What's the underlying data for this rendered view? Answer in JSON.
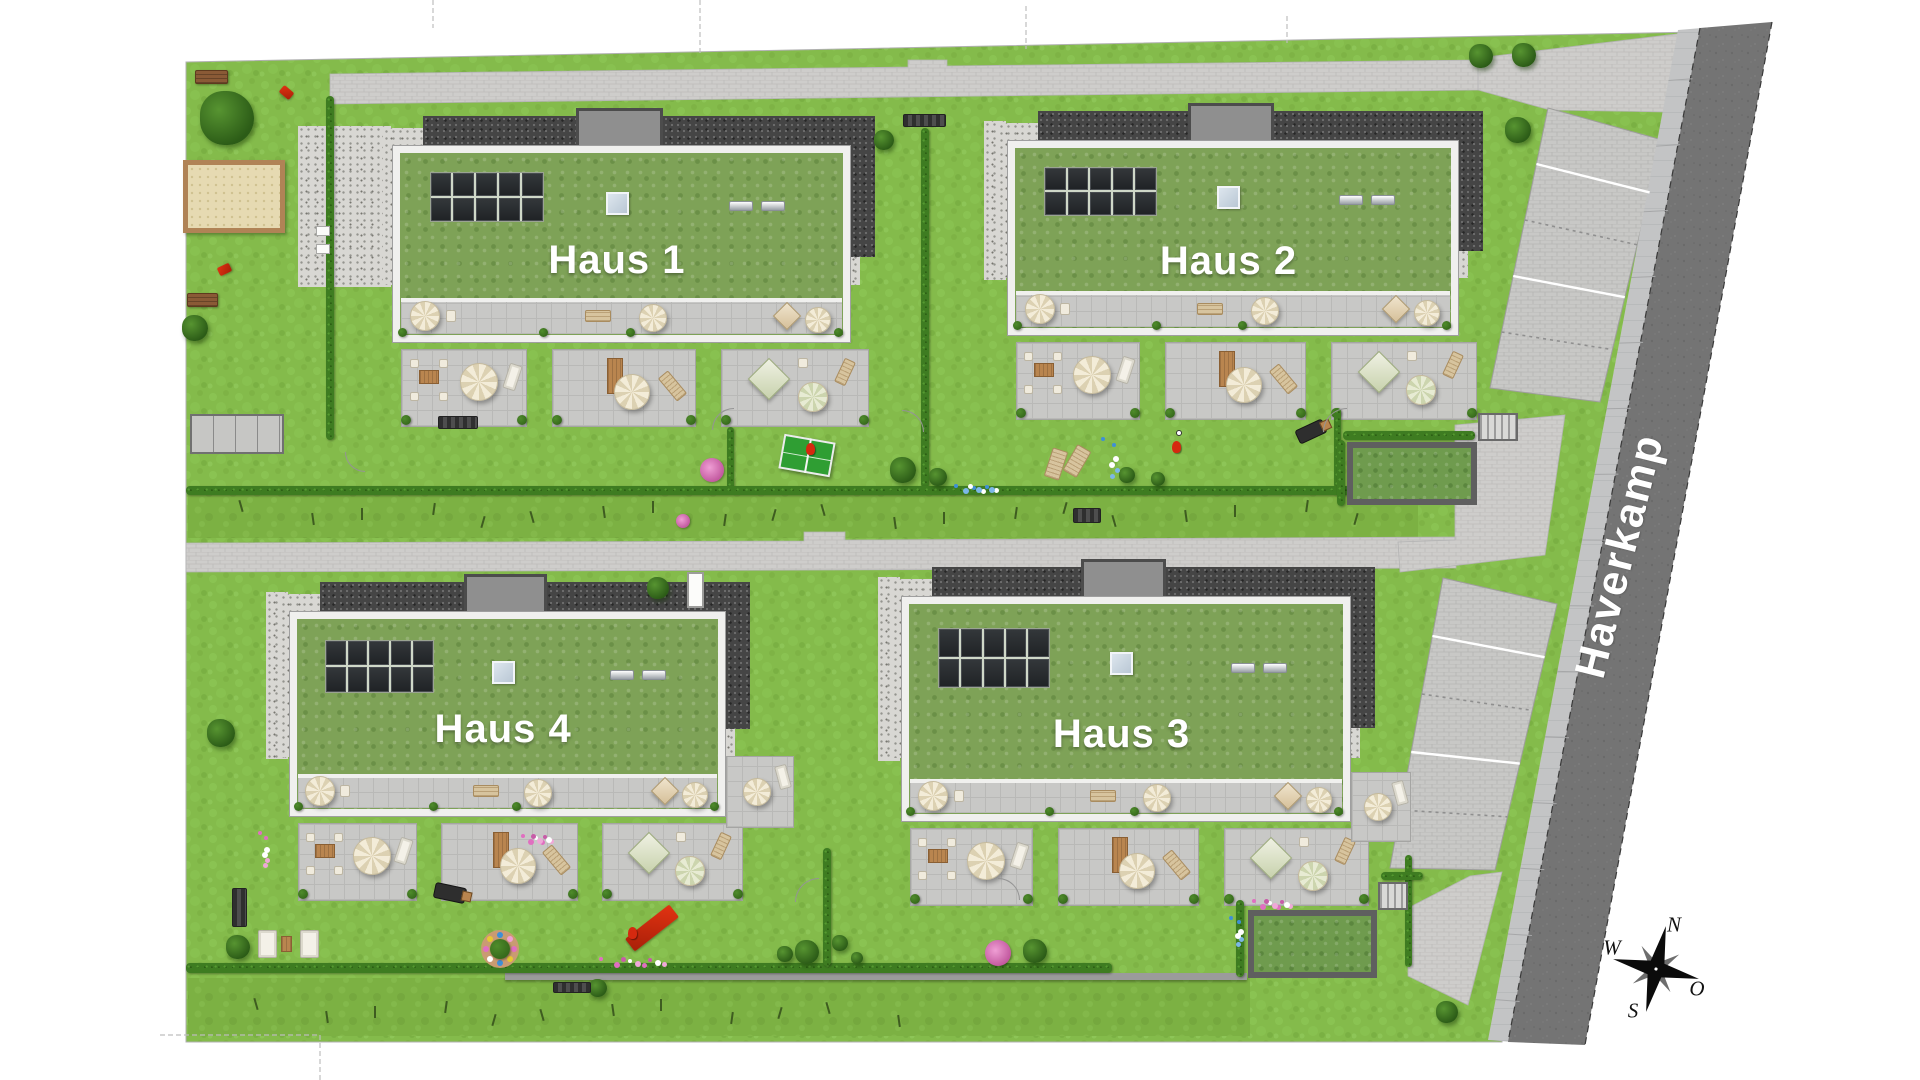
{
  "street": {
    "name": "Haverkamp"
  },
  "compass": {
    "n": "N",
    "o": "O",
    "s": "S",
    "w": "W"
  },
  "houses": [
    {
      "label": "Haus 1",
      "bx": 393,
      "by": 146,
      "bw": 457,
      "bh": 196,
      "attic": 44,
      "court": 95,
      "labelFrac": 0.75
    },
    {
      "label": "Haus 2",
      "bx": 1008,
      "by": 141,
      "bw": 450,
      "bh": 194,
      "attic": 44,
      "court": 24,
      "labelFrac": 0.8
    },
    {
      "label": "Haus 3",
      "bx": 902,
      "by": 597,
      "bw": 448,
      "bh": 224,
      "attic": 42,
      "court": 24,
      "labelFrac": 0.75,
      "extra_pad": [
        1352,
        773,
        58,
        68
      ]
    },
    {
      "label": "Haus 4",
      "bx": 290,
      "by": 612,
      "bw": 435,
      "bh": 204,
      "attic": 42,
      "court": 24,
      "labelFrac": 0.72,
      "extra_pad": [
        727,
        757,
        66,
        70
      ]
    }
  ],
  "palette": {
    "grass": "#84bb4b",
    "meadow": "#7cb143",
    "roof_green": "#7ea257",
    "road": "#747474",
    "sidewalk": "#c3c4c5",
    "paving": "#cecdcb",
    "parking": "#c8c8c6",
    "dark_gravel": "#454545",
    "hedge": "#3e7c21",
    "label_text": "#ffffff",
    "solar": "#2b2e31",
    "accent_red": "#d5290f",
    "sand": "#e6dab2",
    "parapet": "#f0f0ee"
  },
  "scene": {
    "grass": [
      [
        186,
        62
      ],
      [
        1697,
        32
      ],
      [
        1502,
        1042
      ],
      [
        186,
        1042
      ]
    ],
    "meadows": [
      [
        188,
        492,
        1230,
        46
      ],
      [
        188,
        978,
        1062,
        58
      ]
    ],
    "walk_top": [
      [
        330,
        74
      ],
      [
        908,
        67
      ],
      [
        908,
        60
      ],
      [
        947,
        60
      ],
      [
        947,
        66
      ],
      [
        1480,
        60
      ],
      [
        1480,
        90
      ],
      [
        330,
        104
      ]
    ],
    "drive_top": [
      [
        1478,
        58
      ],
      [
        1693,
        32
      ],
      [
        1666,
        112
      ],
      [
        1550,
        110
      ],
      [
        1478,
        90
      ]
    ],
    "walk_mid": [
      [
        186,
        543
      ],
      [
        804,
        541
      ],
      [
        804,
        532
      ],
      [
        845,
        532
      ],
      [
        845,
        540
      ],
      [
        1456,
        537
      ],
      [
        1456,
        568
      ],
      [
        186,
        572
      ]
    ],
    "exit_mid": [
      [
        1455,
        425
      ],
      [
        1565,
        415
      ],
      [
        1545,
        555
      ],
      [
        1400,
        572
      ],
      [
        1398,
        542
      ],
      [
        1455,
        540
      ]
    ],
    "exit_low": [
      [
        1408,
        908
      ],
      [
        1470,
        876
      ],
      [
        1502,
        872
      ],
      [
        1468,
        1005
      ],
      [
        1408,
        976
      ]
    ],
    "park_upper": [
      [
        1548,
        108
      ],
      [
        1662,
        140
      ],
      [
        1600,
        402
      ],
      [
        1490,
        388
      ]
    ],
    "park_lower": [
      [
        1443,
        578
      ],
      [
        1557,
        604
      ],
      [
        1495,
        870
      ],
      [
        1390,
        868
      ]
    ],
    "sidewalk": [
      [
        1678,
        30
      ],
      [
        1702,
        28
      ],
      [
        1512,
        1042
      ],
      [
        1488,
        1040
      ]
    ],
    "road": [
      [
        1700,
        28
      ],
      [
        1772,
        22
      ],
      [
        1585,
        1045
      ],
      [
        1508,
        1042
      ]
    ],
    "road_edges": [
      [
        1700,
        28,
        1508,
        1042
      ],
      [
        1772,
        22,
        1585,
        1045
      ]
    ],
    "boundaries": [
      [
        433,
        0,
        433,
        28
      ],
      [
        700,
        0,
        700,
        53
      ],
      [
        1026,
        6,
        1026,
        49
      ],
      [
        1287,
        16,
        1287,
        43
      ],
      [
        160,
        1035,
        320,
        1035
      ],
      [
        320,
        1035,
        320,
        1080
      ]
    ],
    "wall": [
      505,
      973,
      742,
      7
    ],
    "hedges": [
      [
        326,
        96,
        8,
        344
      ],
      [
        921,
        128,
        8,
        360
      ],
      [
        727,
        427,
        7,
        62
      ],
      [
        1334,
        408,
        7,
        80
      ],
      [
        186,
        486,
        1236,
        9
      ],
      [
        186,
        963,
        926,
        10
      ],
      [
        823,
        848,
        8,
        118
      ],
      [
        1405,
        855,
        7,
        112
      ],
      [
        1381,
        872,
        42,
        8
      ],
      [
        1343,
        431,
        132,
        9
      ],
      [
        1337,
        440,
        8,
        66
      ],
      [
        1236,
        900,
        8,
        77
      ]
    ],
    "trees": [
      [
        227,
        118,
        27
      ],
      [
        884,
        140,
        10
      ],
      [
        1518,
        130,
        13
      ],
      [
        1481,
        56,
        12
      ],
      [
        1524,
        55,
        12
      ],
      [
        195,
        328,
        13
      ],
      [
        221,
        733,
        14
      ],
      [
        903,
        470,
        13
      ],
      [
        938,
        477,
        9
      ],
      [
        1127,
        475,
        8
      ],
      [
        1158,
        479,
        7
      ],
      [
        658,
        588,
        11
      ],
      [
        785,
        954,
        8
      ],
      [
        807,
        952,
        12
      ],
      [
        840,
        943,
        8
      ],
      [
        857,
        958,
        6
      ],
      [
        238,
        947,
        12
      ],
      [
        1035,
        951,
        12
      ],
      [
        1447,
        1012,
        11
      ],
      [
        598,
        988,
        9
      ]
    ],
    "benches_wood": [
      [
        195,
        70,
        33,
        14
      ],
      [
        187,
        293,
        31,
        14
      ]
    ],
    "benches_dark": [
      [
        903,
        114,
        43,
        13
      ],
      [
        438,
        416,
        40,
        13
      ],
      [
        1073,
        508,
        28,
        15
      ],
      [
        232,
        888,
        15,
        39
      ],
      [
        553,
        982,
        38,
        11
      ]
    ],
    "sandbox": [
      183,
      160,
      102,
      73
    ],
    "bike_shelter": [
      190,
      414,
      94,
      40
    ],
    "green_shelters": [
      [
        1347,
        442,
        130,
        63
      ],
      [
        1248,
        910,
        129,
        68
      ]
    ],
    "stairs": [
      [
        1478,
        413,
        40,
        28
      ],
      [
        1378,
        882,
        30,
        28
      ]
    ],
    "pingpong": [
      781,
      438,
      52,
      35,
      10
    ],
    "garden_loungers": [
      [
        1048,
        449,
        16,
        30,
        18
      ],
      [
        1069,
        446,
        16,
        30,
        30
      ],
      [
        258,
        930,
        19,
        28,
        0
      ],
      [
        300,
        930,
        19,
        28,
        0
      ]
    ],
    "small_table": [
      281,
      936,
      11,
      16
    ],
    "grills": [
      [
        1296,
        424,
        30,
        15,
        -25
      ],
      [
        434,
        885,
        32,
        16,
        12
      ]
    ],
    "red_toys": [
      [
        280,
        88,
        13,
        9,
        40
      ],
      [
        218,
        265,
        13,
        9,
        -25
      ]
    ],
    "red_slide": [
      644,
      900,
      16,
      56,
      52
    ],
    "red_figures": [
      [
        1172,
        441
      ],
      [
        628,
        927
      ],
      [
        806,
        443
      ]
    ],
    "ball": [
      1176,
      430
    ],
    "flower_blue_v": [
      [
        1100,
        432,
        16,
        54
      ],
      [
        1228,
        912,
        12,
        38
      ]
    ],
    "flower_rows": [
      [
        950,
        483,
        48,
        8,
        "blue"
      ],
      [
        593,
        956,
        76,
        9,
        "pink"
      ],
      [
        1248,
        898,
        44,
        9,
        "pink"
      ],
      [
        518,
        833,
        34,
        9,
        "pink"
      ]
    ],
    "flower_pink_v": [
      257,
      826,
      9,
      48
    ],
    "flower_bushes": [
      [
        712,
        470,
        12
      ],
      [
        998,
        953,
        13
      ],
      [
        683,
        521,
        7
      ]
    ],
    "flowerbed": [
      500,
      949,
      19
    ],
    "white_box": [
      687,
      572,
      17,
      36
    ],
    "court_items": [
      [
        316,
        226,
        14,
        10
      ],
      [
        316,
        244,
        14,
        10
      ]
    ],
    "gate_arcs": [
      [
        712,
        408,
        22,
        0
      ],
      [
        902,
        410,
        22,
        90
      ],
      [
        1323,
        408,
        24,
        0
      ],
      [
        795,
        878,
        24,
        0
      ],
      [
        998,
        878,
        22,
        90
      ],
      [
        345,
        452,
        20,
        270
      ]
    ],
    "sapling_rows": [
      [
        240,
        500,
        20,
        58
      ],
      [
        255,
        998,
        12,
        57
      ]
    ]
  }
}
